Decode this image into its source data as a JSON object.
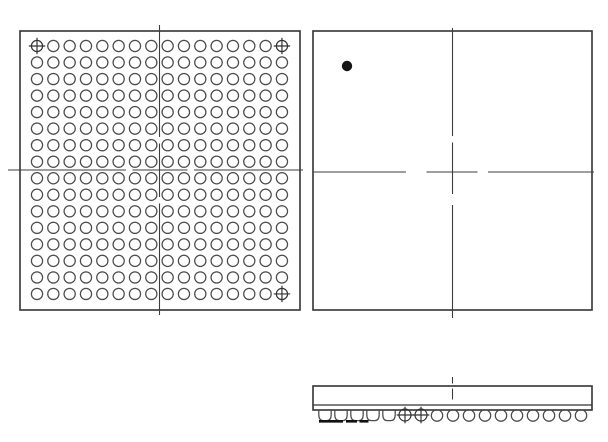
{
  "drawing": {
    "kind": "bga-package-mechanical-drawing",
    "canvas": {
      "width": 608,
      "height": 442,
      "background": "#ffffff"
    },
    "colors": {
      "outline": "#333333",
      "centerline": "#3d3d3d",
      "ball_stroke": "#4c4c4c",
      "fiducial_stroke": "#333333",
      "pin1_dot_fill": "#161616",
      "seating_mark": "#111111"
    },
    "stroke_widths": {
      "outline": 1.6,
      "centerline": 1.1,
      "ball": 1.25,
      "fiducial": 1.2,
      "seam": 1.2,
      "seating_mark": 2.6
    },
    "views": {
      "bottom_view": {
        "box": {
          "x": 20,
          "y": 31,
          "width": 280,
          "height": 279
        },
        "ball_grid": {
          "rows": 16,
          "cols": 16,
          "origin": [
            37,
            46
          ],
          "pitch": [
            16.33,
            16.53
          ],
          "ball_radius": 5.6,
          "fiducial_cells": [
            [
              0,
              0
            ],
            [
              15,
              0
            ],
            [
              15,
              15
            ]
          ],
          "fiducial_cross_half": 8.2
        },
        "centerline_vertical": {
          "x": 159.5,
          "segments": [
            [
              25,
              137
            ],
            [
              143.5,
              197
            ],
            [
              203.5,
              315
            ]
          ]
        },
        "centerline_horizontal": {
          "y": 170,
          "segments": [
            [
              8,
              126
            ],
            [
              132.5,
              187.5
            ],
            [
              194,
              303
            ]
          ]
        }
      },
      "top_view": {
        "box": {
          "x": 313,
          "y": 31,
          "width": 279,
          "height": 279
        },
        "pin1_dot": {
          "cx": 347,
          "cy": 66,
          "r": 4.7
        },
        "centerline_vertical": {
          "x": 452.5,
          "segments": [
            [
              28,
              136
            ],
            [
              142.5,
              194
            ],
            [
              205,
              318
            ]
          ]
        },
        "centerline_horizontal": {
          "y": 172,
          "segments": [
            [
              313,
              406
            ],
            [
              426.5,
              477.5
            ],
            [
              488,
              594
            ]
          ]
        }
      },
      "side_view": {
        "body": {
          "x": 313,
          "y": 386,
          "width": 279,
          "height": 24
        },
        "seam_y": 405,
        "top_tick": {
          "x": 452.5,
          "segments": [
            [
              377,
              383.5
            ],
            [
              388.5,
              399.5
            ]
          ]
        },
        "balls": {
          "count": 17,
          "start_x": 325,
          "pitch": 16,
          "center_y": 415.5,
          "radius": 5.7,
          "collapsed_indices": [
            0,
            1,
            2,
            3,
            4
          ],
          "fiducial_indices": [
            5,
            6
          ],
          "fiducial_radius": 6,
          "fiducial_cross_half": 8.3,
          "collapsed_half_width": 6.2,
          "collapsed_top_y": 410.3,
          "collapsed_bottom_y": 420.6
        },
        "seating_marks": {
          "y": 421.3,
          "segments": [
            [
              319,
              343
            ],
            [
              346,
              357
            ],
            [
              359.5,
              368.5
            ]
          ]
        }
      }
    }
  }
}
